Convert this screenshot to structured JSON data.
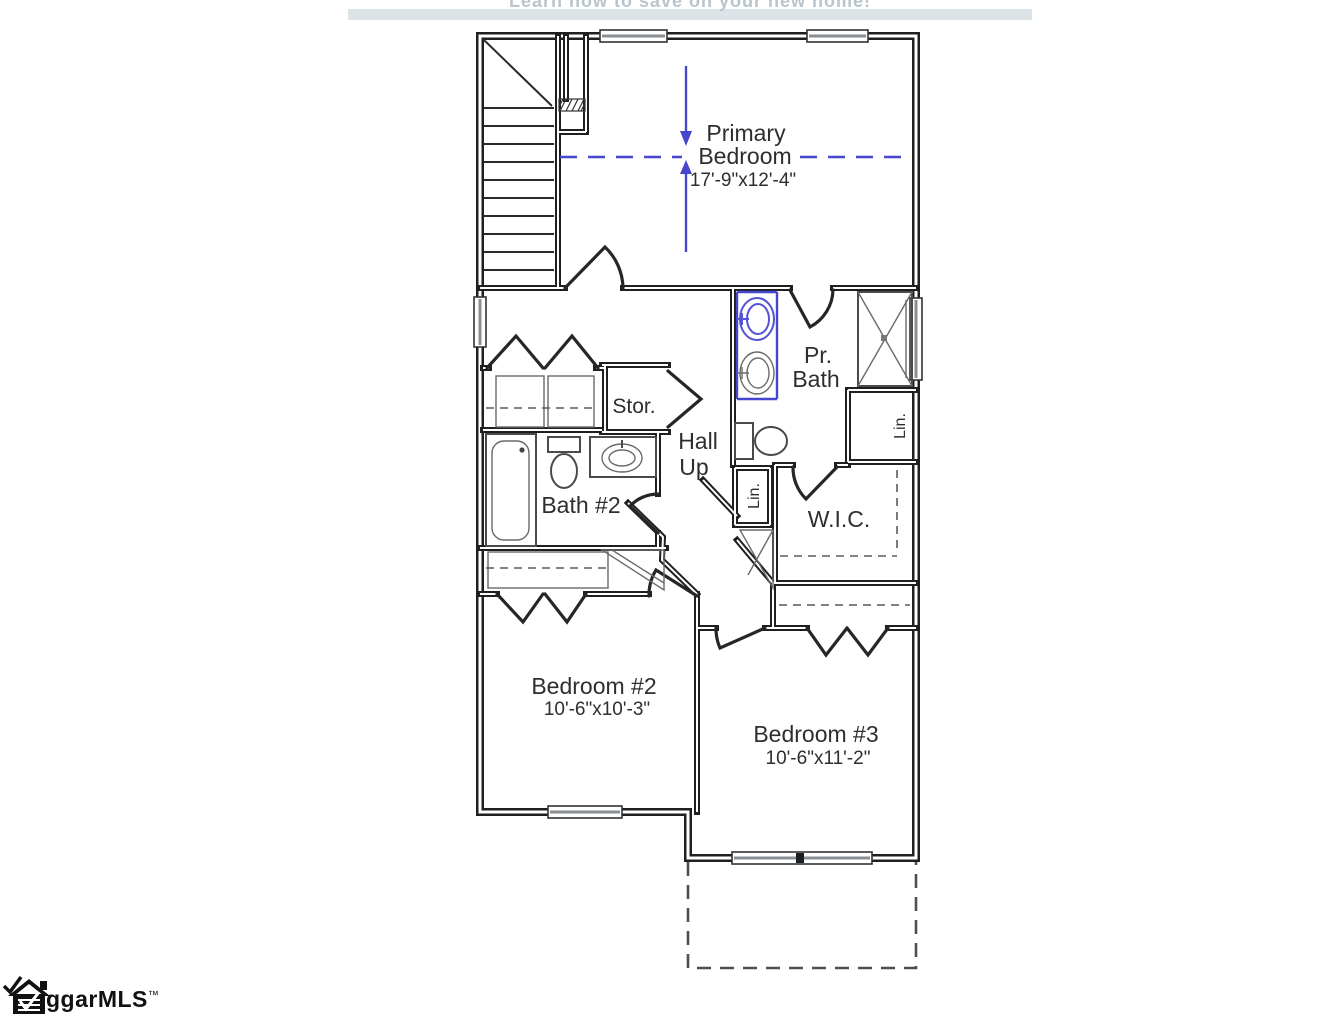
{
  "watermark": {
    "text": "Learn how to save on your new home!"
  },
  "plan": {
    "rooms": {
      "primary_bedroom": {
        "name_line1": "Primary",
        "name_line2": "Bedroom",
        "dims": "17'-9\"x12'-4\""
      },
      "pr_bath": {
        "name_line1": "Pr.",
        "name_line2": "Bath"
      },
      "storage": {
        "name": "Stor."
      },
      "hall": {
        "name_line1": "Hall",
        "name_line2": "Up"
      },
      "bath_2": {
        "name": "Bath #2"
      },
      "linen_upper": {
        "name": "Lin."
      },
      "linen_lower": {
        "name": "Lin."
      },
      "wic": {
        "name": "W.I.C."
      },
      "bedroom_2": {
        "name": "Bedroom #2",
        "dims": "10'-6\"x10'-3\""
      },
      "bedroom_3": {
        "name": "Bedroom #3",
        "dims": "10'-6\"x11'-2\""
      }
    }
  },
  "logo": {
    "name": "ggarMLS",
    "trademark": "™"
  },
  "colors": {
    "wall": "#1f1f1f",
    "fixture_gray": "#4a4a4a",
    "accent_blue": "#4646ce",
    "sink_highlight_blue": "#5553d6",
    "watermark_text": "#b9c5cc",
    "watermark_bar": "#dde4e8"
  }
}
